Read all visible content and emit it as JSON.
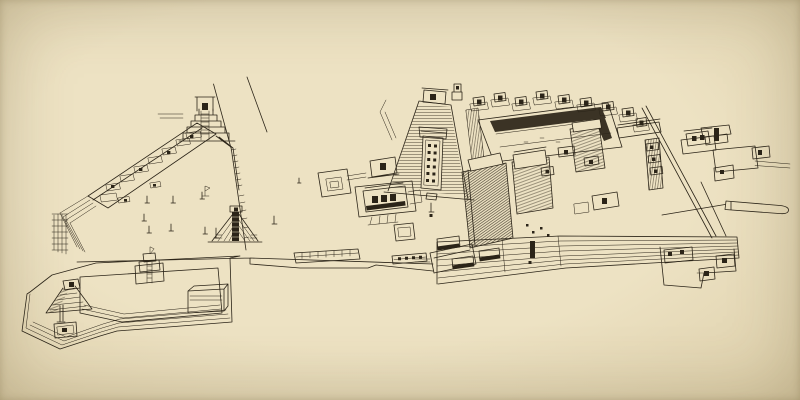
{
  "scene": {
    "kind": "pen-and-ink axonometric reconstruction drawing",
    "subject": "bird's-eye view of an ancient Maya ceremonial center with plazas, stepped pyramids, temples, stelae, a causeway and a terraced acropolis",
    "colors": {
      "paper": "#ede2c3",
      "paper_edge": "#dcce a9",
      "ink": "#2b2418",
      "ink_soft": "#46ance"
    }
  },
  "colors": {
    "paper": "#ede2c3",
    "paper_edge": "#dccea9",
    "ink": "#2b2418",
    "ink_soft": "#4a4232"
  },
  "structures": [
    "survey-lines",
    "great-plaza",
    "altar-row-terrace",
    "north-stepped-pyramid",
    "plaza-east-wall",
    "plaza-stelae",
    "radial-platform",
    "west-gateway-tower",
    "south-platform",
    "south-platform-pyramid",
    "south-platform-altar",
    "tiered-altar",
    "causeway",
    "causeway-buildings",
    "offering-altar",
    "west-temple-group",
    "hieroglyphic-stairway-temple",
    "acropolis-court",
    "court-rim-temples",
    "central-pyramid-masses",
    "acropolis-south-terraces",
    "terrace-stela",
    "west-base-platforms",
    "east-edge-lines",
    "east-temple-group",
    "east-spur-platform",
    "southeast-annex"
  ]
}
